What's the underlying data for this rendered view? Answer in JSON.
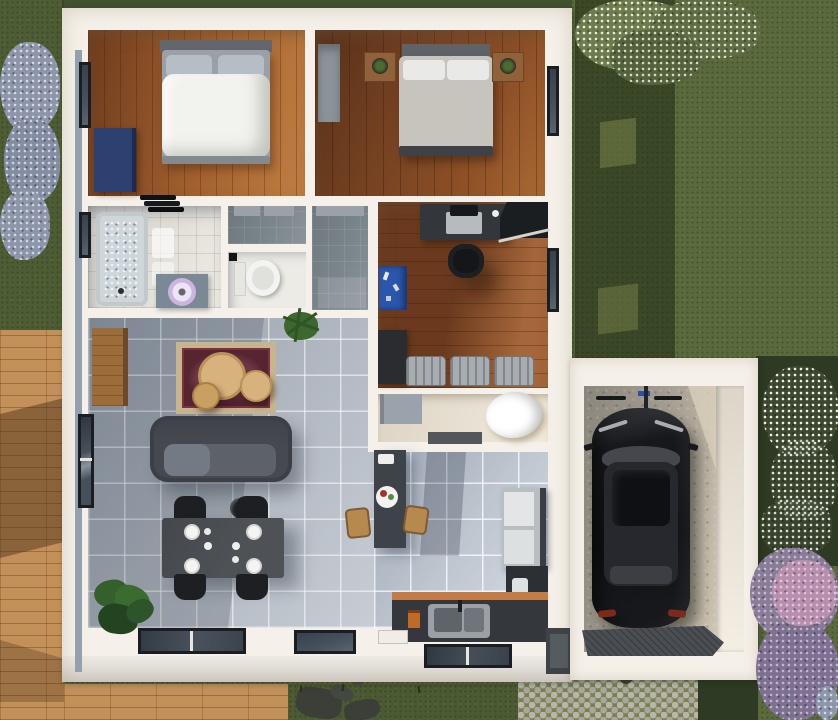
{
  "scene": {
    "type": "3d-floor-plan-top-view",
    "label": "3D rendered top-down floor plan of a house with garage, deck and garden"
  },
  "palette": {
    "grass": "#5a6a3c",
    "grassTop": "#42512f",
    "deck": "#c3905a",
    "wall": "#f5f1ea",
    "wallStrip": "#93a0ad",
    "wood1a": "#6f3c1e",
    "wood1b": "#a05f2e",
    "wood1c": "#c17e42",
    "wood2a": "#57301a",
    "wood2b": "#8c4f27",
    "wood3a": "#6b3a1e",
    "wood3b": "#a4663a",
    "tileA": "#929ca8",
    "tileB": "#c8cdd5",
    "bathTile": "#e4e1da",
    "hallTile": "#7b858c",
    "utilFloor": "#e8e1d3",
    "sofa": "#46494f",
    "sofaSeat": "#5d6168",
    "rugField": "#572431",
    "rugBorder": "#c7b58f",
    "rugMid": "#8d4b58",
    "tableTan": "#d7b27c",
    "dining": "#4e5257",
    "chair": "#1d1f23",
    "island": "#3e4349",
    "stool": "#b68a4e",
    "fridge": "#b9bec2",
    "fridgeDark": "#3a3e42",
    "counter": "#34383d",
    "counterEdge": "#c47c46",
    "sink": "#9aa0a5",
    "tub": "#e2e6e8",
    "vanity": "#7b8895",
    "toilet": "#f3f3f1",
    "concreteA": "#8b867c",
    "concreteB": "#cfc5b4",
    "car": "#141519",
    "carRoof": "#26282d",
    "glass": "#45474c",
    "tail": "#7e2a1a",
    "mat": "#4a4d51",
    "cobbleStone": "#b9b5ac",
    "cobbleBase": "#78824f",
    "bushBlue": "#8d95a9",
    "bushWhite": "#dde3dc",
    "bushPurple": "#897c97",
    "bushPink": "#b78fae",
    "stone": "#3b3f37",
    "windowFrame": "#1a1d21",
    "windowGlass": "#47525d",
    "bedWhite": "#f2f2ef",
    "pillow": "#b7bdc5",
    "headboard": "#63666c",
    "duvet2": "#c7c4bd",
    "dresser": "#2c4170",
    "bench": "#a7acb1",
    "plant": "#34602c",
    "plantDark": "#234420"
  },
  "outdoor": {
    "lawn": {
      "label": "lawn"
    },
    "house_shadow": {
      "label": "house shadow on lawn"
    },
    "deck": {
      "label": "wooden deck"
    },
    "cobble_path": {
      "label": "cobblestone driveway path"
    },
    "stepping_stones": {
      "label": "stepping stones"
    },
    "bushes": {
      "blue": {
        "label": "blue flowering bush"
      },
      "white": {
        "label": "white flowering bush"
      },
      "purple": {
        "label": "purple flowering bush"
      },
      "tree": {
        "label": "white blossom tree"
      }
    }
  },
  "house": {
    "label": "house",
    "rooms": {
      "bedroom1": {
        "label": "bedroom 1",
        "bed": "double bed",
        "dresser": "blue dresser",
        "window": "window"
      },
      "bedroom2": {
        "label": "bedroom 2",
        "bed": "double bed",
        "nightstand": "nightstand",
        "rug": "runner rug"
      },
      "bathroom": {
        "label": "bathroom",
        "bathtub": "bathtub",
        "vanity": "vanity with sink",
        "towels": "towel stack"
      },
      "wc": {
        "label": "WC",
        "toilet": "toilet"
      },
      "hallway": {
        "label": "hallway / closet",
        "shelf": "closet shelf",
        "plant": "potted plant"
      },
      "office": {
        "label": "office",
        "desk": "desk with laptop",
        "chair": "office chair",
        "cabinet": "corner cabinet",
        "workbench": "blue workbench",
        "bench": "upholstered chairs"
      },
      "utility": {
        "label": "utility room",
        "tub": "freestanding tub",
        "table": "gray table",
        "mat": "floor mat"
      },
      "living": {
        "label": "living room",
        "sofa": "sofa",
        "rug": "oriental rug",
        "coffee_tables": "round coffee tables",
        "sideboard": "sideboard",
        "stools": "round stools",
        "plant": "potted plant",
        "window": "picture window"
      },
      "dining": {
        "label": "dining area",
        "table": "dining table",
        "chairs": "dining chairs",
        "plates": "place settings"
      },
      "kitchen": {
        "label": "kitchen",
        "island": "kitchen island",
        "bar_stools": "bar stools",
        "fridge": "fridge",
        "cabinet": "tall cabinet",
        "counter": "counter with sink",
        "windows": "floor windows"
      }
    }
  },
  "garage": {
    "label": "garage",
    "car": {
      "label": "black car",
      "color": "#141519"
    },
    "floor": {
      "label": "concrete floor"
    },
    "mat": {
      "label": "rubber entry mat"
    }
  }
}
